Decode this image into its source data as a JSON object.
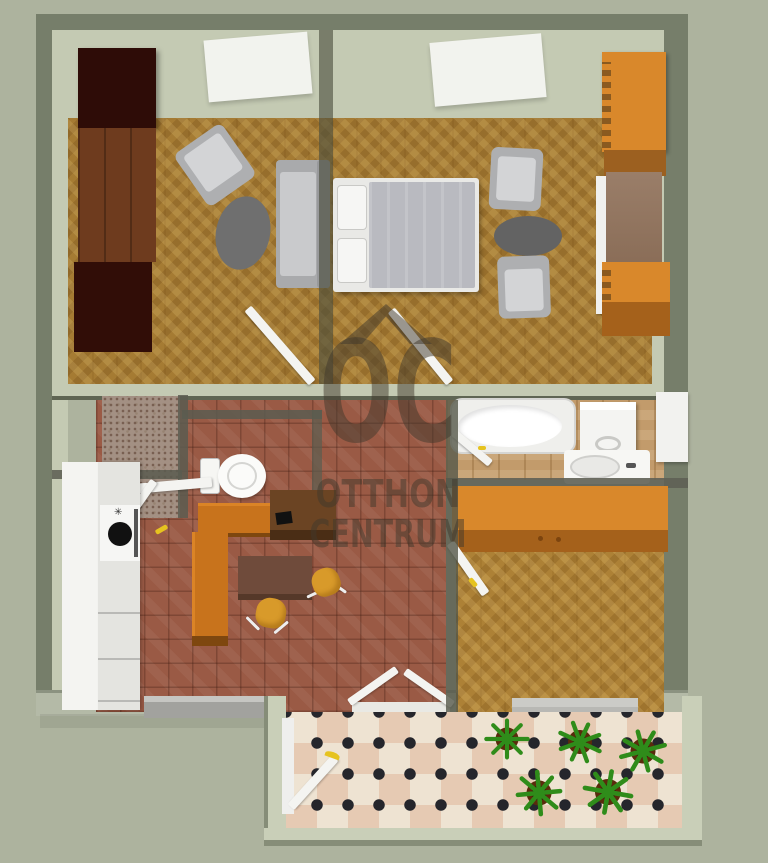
{
  "watermark": {
    "monogram": "OC",
    "brand_line1": "OTTHON",
    "brand_line2": "CENTRUM"
  },
  "scene": {
    "description": "3D rendered top-down apartment floor plan",
    "rooms": [
      "living-room",
      "bedroom",
      "kitchen-dining",
      "wc",
      "bathroom",
      "hallway",
      "terrace"
    ]
  },
  "palette": {
    "background": "#adb39e",
    "wall_dark": "#767e6a",
    "wall_light": "#c4cab3",
    "parquet": "#a57b33",
    "kitchen_tile": "#9a5a45",
    "bath_tile": "#c29b6b",
    "accent_orange": "#d9882b",
    "wardrobe_dark": "#2e0c07",
    "wardrobe_brown": "#6e3b1e",
    "furniture_gray": "#b6b7b9",
    "chair_yellow": "#d89a2a",
    "terrace_tile_pink": "#e6cab3",
    "terrace_tile_cream": "#eee3d2",
    "plant_green": "#2f8c1a",
    "handle_yellow": "#e6c31f",
    "watermark_color": "rgba(64,55,44,0.5)"
  }
}
